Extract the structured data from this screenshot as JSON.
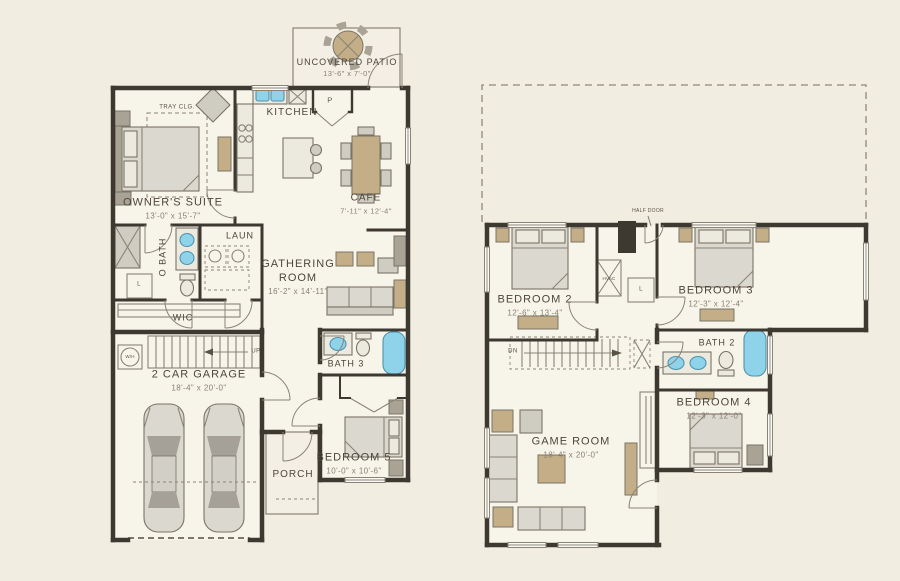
{
  "colors": {
    "background": "#f1ede1",
    "wall": "#3d3931",
    "fixture_blue": "#8fd3ea",
    "furniture_tan": "#c4ae88",
    "furniture_gray": "#dbd8cf",
    "label_text": "#4e463a"
  },
  "first_floor": {
    "patio": {
      "label": "UNCOVERED PATIO",
      "dims": "13'-6\" x 7'-0\""
    },
    "kitchen": {
      "label": "KITCHEN"
    },
    "pantry": {
      "label": "P"
    },
    "owners_suite": {
      "label": "OWNER'S SUITE",
      "dims": "13'-0\" x 15'-7\""
    },
    "tray_ceiling": {
      "label": "TRAY CLG."
    },
    "cafe": {
      "label": "CAFE",
      "dims": "7'-11\" x 12'-4\""
    },
    "owners_bath": {
      "label": "O BATH"
    },
    "laundry": {
      "label": "LAUN"
    },
    "linen": {
      "label": "L"
    },
    "gathering_room": {
      "label": "GATHERING ROOM",
      "dims": "16'-2\" x 14'-11\""
    },
    "wic": {
      "label": "WIC"
    },
    "water_heater": {
      "label": "W/H"
    },
    "stairs_up": {
      "label": "UP"
    },
    "garage": {
      "label": "2 CAR GARAGE",
      "dims": "18'-4\" x 20'-0\""
    },
    "bath3": {
      "label": "BATH 3"
    },
    "bedroom5": {
      "label": "BEDROOM 5",
      "dims": "10'-0\" x 10'-6\""
    },
    "porch": {
      "label": "PORCH"
    }
  },
  "second_floor": {
    "half_door": {
      "label": "HALF DOOR"
    },
    "bedroom2": {
      "label": "BEDROOM 2",
      "dims": "12'-6\" x 13'-4\""
    },
    "bedroom3": {
      "label": "BEDROOM 3",
      "dims": "12'-3\" x 12'-4\""
    },
    "hvac": {
      "label": "HVAC"
    },
    "linen": {
      "label": "L"
    },
    "bath2": {
      "label": "BATH 2"
    },
    "bedroom4": {
      "label": "BEDROOM 4",
      "dims": "12'-3\" x 12'-0\""
    },
    "game_room": {
      "label": "GAME ROOM",
      "dims": "18'-4\" x 20'-0\""
    },
    "stairs_down": {
      "label": "DN"
    }
  }
}
